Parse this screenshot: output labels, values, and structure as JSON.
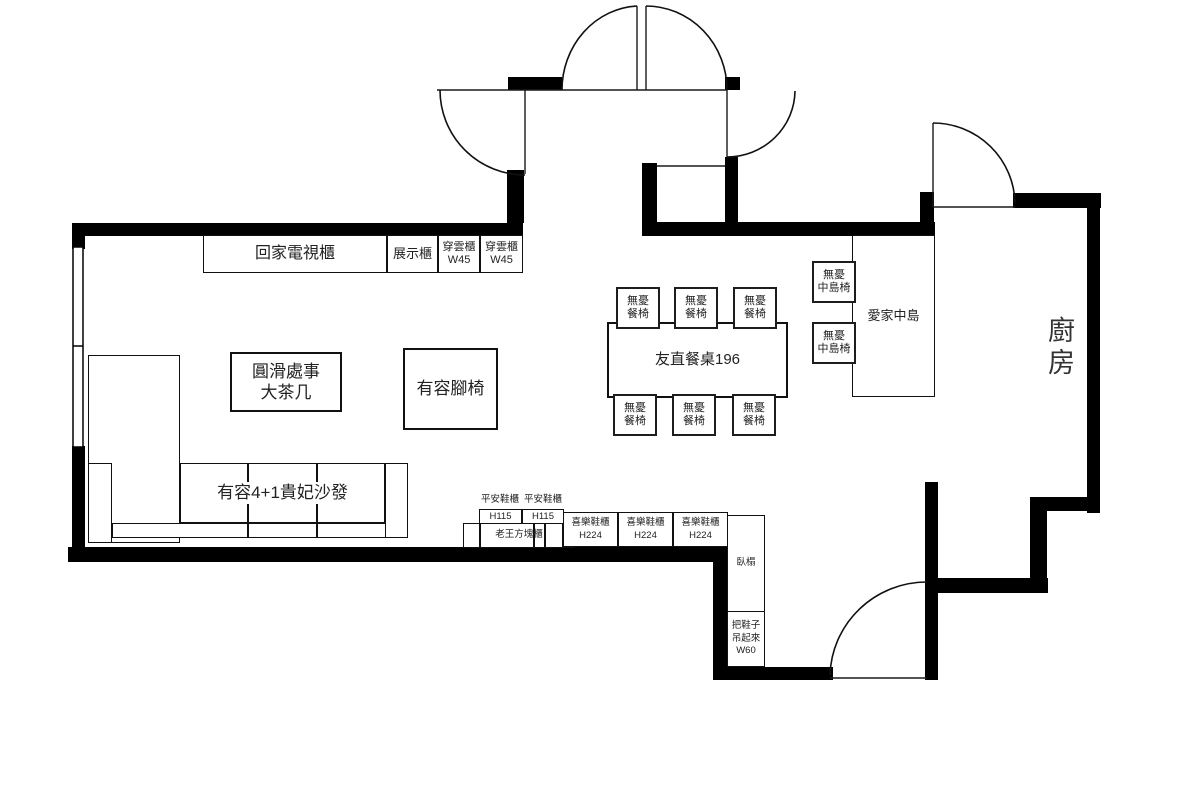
{
  "plan": {
    "kitchen_label": "廚房",
    "labels": {
      "tv_cabinet": "回家電視櫃",
      "display_cabinet": "展示櫃",
      "cloud_cabinet": [
        "穿雲櫃",
        "W45"
      ],
      "coffee_table": [
        "圓滑處事",
        "大茶几"
      ],
      "footstool": "有容腳椅",
      "sofa": "有容4+1貴妃沙發",
      "dining_table": "友直餐桌196",
      "dining_chair": [
        "無憂",
        "餐椅"
      ],
      "island": "愛家中島",
      "island_chair": [
        "無憂",
        "中島椅"
      ],
      "pingan_cabinet": "平安鞋櫃",
      "pingan_size": "H115",
      "cube_cabinet": "老王方塊櫃",
      "joy_shoe_cabinet": [
        "喜樂鞋櫃",
        "H224"
      ],
      "daybed": "臥榻",
      "shoe_hanger": [
        "把鞋子",
        "吊起來",
        "W60"
      ]
    },
    "colors": {
      "wall": "#000000",
      "line": "#1a1a1a",
      "text": "#222222",
      "background": "#ffffff"
    }
  }
}
